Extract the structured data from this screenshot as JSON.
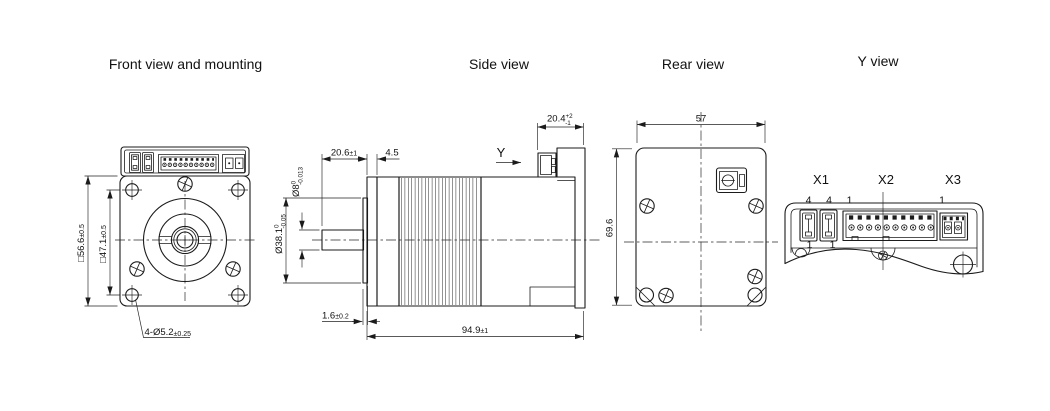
{
  "drawing": {
    "front_view": {
      "title": "Front view and mounting",
      "dim_body_width": {
        "main": "□56.6",
        "tol": "±0.5"
      },
      "dim_hole_spacing": {
        "main": "□47.1",
        "tol": "±0.5"
      },
      "dim_mounting_holes": {
        "main": "4-Ø5.2",
        "tol": "±0.25"
      }
    },
    "side_view": {
      "title": "Side view",
      "dim_shaft_length": {
        "main": "20.6",
        "tol": "±1"
      },
      "dim_flange_thickness": {
        "main": "4.5"
      },
      "dim_shaft_diameter": {
        "main": "Ø8",
        "tol_upper": "0",
        "tol_lower": "-0.013"
      },
      "dim_pilot_diameter": {
        "main": "Ø38.1",
        "tol_upper": "0",
        "tol_lower": "-0.05"
      },
      "dim_pilot_height": {
        "main": "1.6",
        "tol": "±0.2"
      },
      "dim_total_length": {
        "main": "94.9",
        "tol": "±1"
      },
      "dim_connector_height": {
        "main": "20.4",
        "tol_upper": "+2",
        "tol_lower": "-1"
      },
      "view_direction_marker": "Y"
    },
    "rear_view": {
      "title": "Rear view",
      "dim_width": "57",
      "dim_height": "69.6"
    },
    "y_view": {
      "title": "Y view",
      "connector_x1": {
        "label": "X1",
        "pin_top_a": "4",
        "pin_top_b": "4",
        "pin_bottom_a": "1",
        "pin_bottom_b": "1"
      },
      "connector_x2": {
        "label": "X2",
        "pin_first": "1"
      },
      "connector_x3": {
        "label": "X3",
        "pin_first": "1"
      }
    }
  }
}
